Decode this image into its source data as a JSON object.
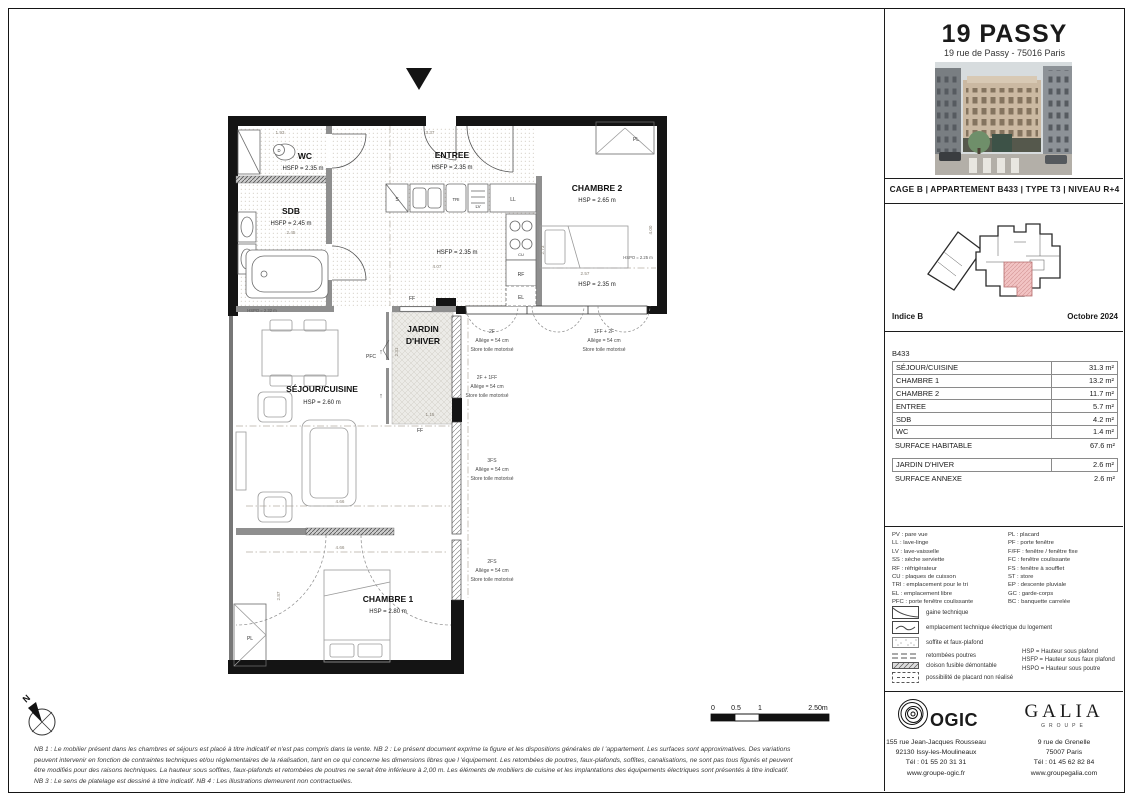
{
  "header": {
    "title": "19 PASSY",
    "subtitle": "19 rue de Passy - 75016 Paris"
  },
  "banner": "CAGE B  |  APPARTEMENT B433  |  TYPE T3  |  NIVEAU R+4",
  "keyplan": {
    "indice": "Indice B",
    "date": "Octobre 2024",
    "highlight_color": "#f2c4c4"
  },
  "surfaces": {
    "unit": "B433",
    "rows": [
      {
        "label": "SÉJOUR/CUISINE",
        "value": "31.3 m²"
      },
      {
        "label": "CHAMBRE 1",
        "value": "13.2 m²"
      },
      {
        "label": "CHAMBRE 2",
        "value": "11.7 m²"
      },
      {
        "label": "ENTREE",
        "value": "5.7 m²"
      },
      {
        "label": "SDB",
        "value": "4.2 m²"
      },
      {
        "label": "WC",
        "value": "1.4 m²"
      }
    ],
    "total": {
      "label": "SURFACE HABITABLE",
      "value": "67.6 m²"
    },
    "annex_rows": [
      {
        "label": "JARDIN D'HIVER",
        "value": "2.6 m²"
      }
    ],
    "annex_total": {
      "label": "SURFACE ANNEXE",
      "value": "2.6 m²"
    }
  },
  "legend": {
    "col1": [
      "PV : pare vue",
      "LL : lave-linge",
      "LV : lave-vaisselle",
      "SS : sèche serviette",
      "RF : réfrigérateur",
      "CU : plaques de cuisson",
      "TRI : emplacement pour le tri",
      "EL : emplacement libre",
      "PFC : porte fenêtre coulissante"
    ],
    "col2": [
      "PL : placard",
      "PF : porte fenêtre",
      "F/FF : fenêtre / fenêtre fixe",
      "FC : fenêtre coulissante",
      "FS : fenêtre à soufflet",
      "ST : store",
      "EP : descente pluviale",
      "GC : garde-corps",
      "BC : banquette carrelée"
    ],
    "symbols": [
      "gaine technique",
      "emplacement technique électrique du logement",
      "soffite et faux-plafond",
      "retombées poutres",
      "cloison fusible démontable",
      "possibilité de placard non réalisé"
    ],
    "heights": [
      "HSP = Hauteur sous plafond",
      "HSFP = Hauteur sous faux plafond",
      "HSPO = Hauteur sous poutre"
    ]
  },
  "plan": {
    "rooms": {
      "wc": {
        "n": "WC",
        "h": "HSFP = 2.35 m"
      },
      "sdb": {
        "n": "SDB",
        "h": "HSFP = 2.45 m",
        "d": "2.45"
      },
      "entree": {
        "n": "ENTREE",
        "h": "HSFP = 2.35 m"
      },
      "chambre2": {
        "n": "CHAMBRE 2",
        "h": "HSP = 2.65 m",
        "h2": "HSP = 2.35 m",
        "beam": "HSPO = 2.25 m",
        "d1": "2.57",
        "d2": "4.00"
      },
      "cuisine": {
        "h": "HSFP = 2.35 m",
        "d1": "4.07",
        "d2": "2.73"
      },
      "jardin": {
        "n1": "JARDIN",
        "n2": "D'HIVER",
        "d1": "2.31",
        "d2": "1.15"
      },
      "sejour": {
        "n": "SÉJOUR/CUISINE",
        "h": "HSP = 2.60 m",
        "beam": "HSPO = 2.32 m",
        "d1": "4.66"
      },
      "chambre1": {
        "n": "CHAMBRE 1",
        "h": "HSP = 2.80 m",
        "d1": "4.66",
        "d2": "2.87"
      }
    },
    "tags": {
      "pl": "PL",
      "pfc": "PFC",
      "ff": "FF",
      "s": "S",
      "tri": "TRI",
      "lv": "LV",
      "ll": "LL",
      "cu": "CU",
      "rf": "RF",
      "el": "EL",
      "d": "D",
      "up": "↑"
    },
    "dims": {
      "top1": "1.93",
      "top2": "3.37"
    },
    "win": [
      {
        "t": "2F",
        "a": "Allège = 54 cm",
        "s": "Store toile motorisé"
      },
      {
        "t": "1FF + 2F",
        "a": "Allège = 54 cm",
        "s": "Store toile motorisé"
      },
      {
        "t": "2F + 1FF",
        "a": "Allège = 54 cm",
        "s": "Store toile motorisé"
      },
      {
        "t": "3FS",
        "a": "Allège = 54 cm",
        "s": "Store toile motorisé"
      },
      {
        "t": "2FS",
        "a": "Allège = 54 cm",
        "s": "Store toile motorisé"
      }
    ],
    "north": "N",
    "scale": {
      "a": "0",
      "b": "0.5",
      "c": "1",
      "d": "2.50m"
    }
  },
  "ogic": {
    "name": "OGIC",
    "lines": [
      "155 rue Jean-Jacques Rousseau",
      "92130 Issy-les-Moulineaux",
      "Tél : 01 55 20 31 31",
      "www.groupe-ogic.fr"
    ]
  },
  "galia": {
    "name": "GALIA",
    "sub": "GROUPE",
    "lines": [
      "9 rue de Grenelle",
      "75007 Paris",
      "Tél : 01 45 62 82 84",
      "www.groupegalia.com"
    ]
  },
  "footer": {
    "lines": [
      "NB 1 : Le mobilier présent dans les chambres et séjours est placé à titre indicatif et n'est pas compris dans la vente. NB 2 : Le présent document exprime la figure et les dispositions générales de l 'appartement. Les surfaces sont approximatives. Des variations",
      "peuvent intervenir en fonction de contraintes techniques et/ou réglementaires de la réalisation, tant en ce qui concerne les dimensions libres que l 'équipement. Les retombées de poutres, faux-plafonds, soffites, canalisations, ne sont pas tous figurés et peuvent",
      "être modifiés pour des raisons techniques. La hauteur sous soffites, faux-plafonds et retombées de poutres ne serait être inférieure à 2,00 m. Les éléments de mobiliers de cuisine et les implantations des équipements électriques sont présentés à titre indicatif.",
      "NB 3 : Le sens de platelage est dessiné à titre indicatif. NB 4 : Les illustrations demeurent non contractuelles."
    ]
  }
}
